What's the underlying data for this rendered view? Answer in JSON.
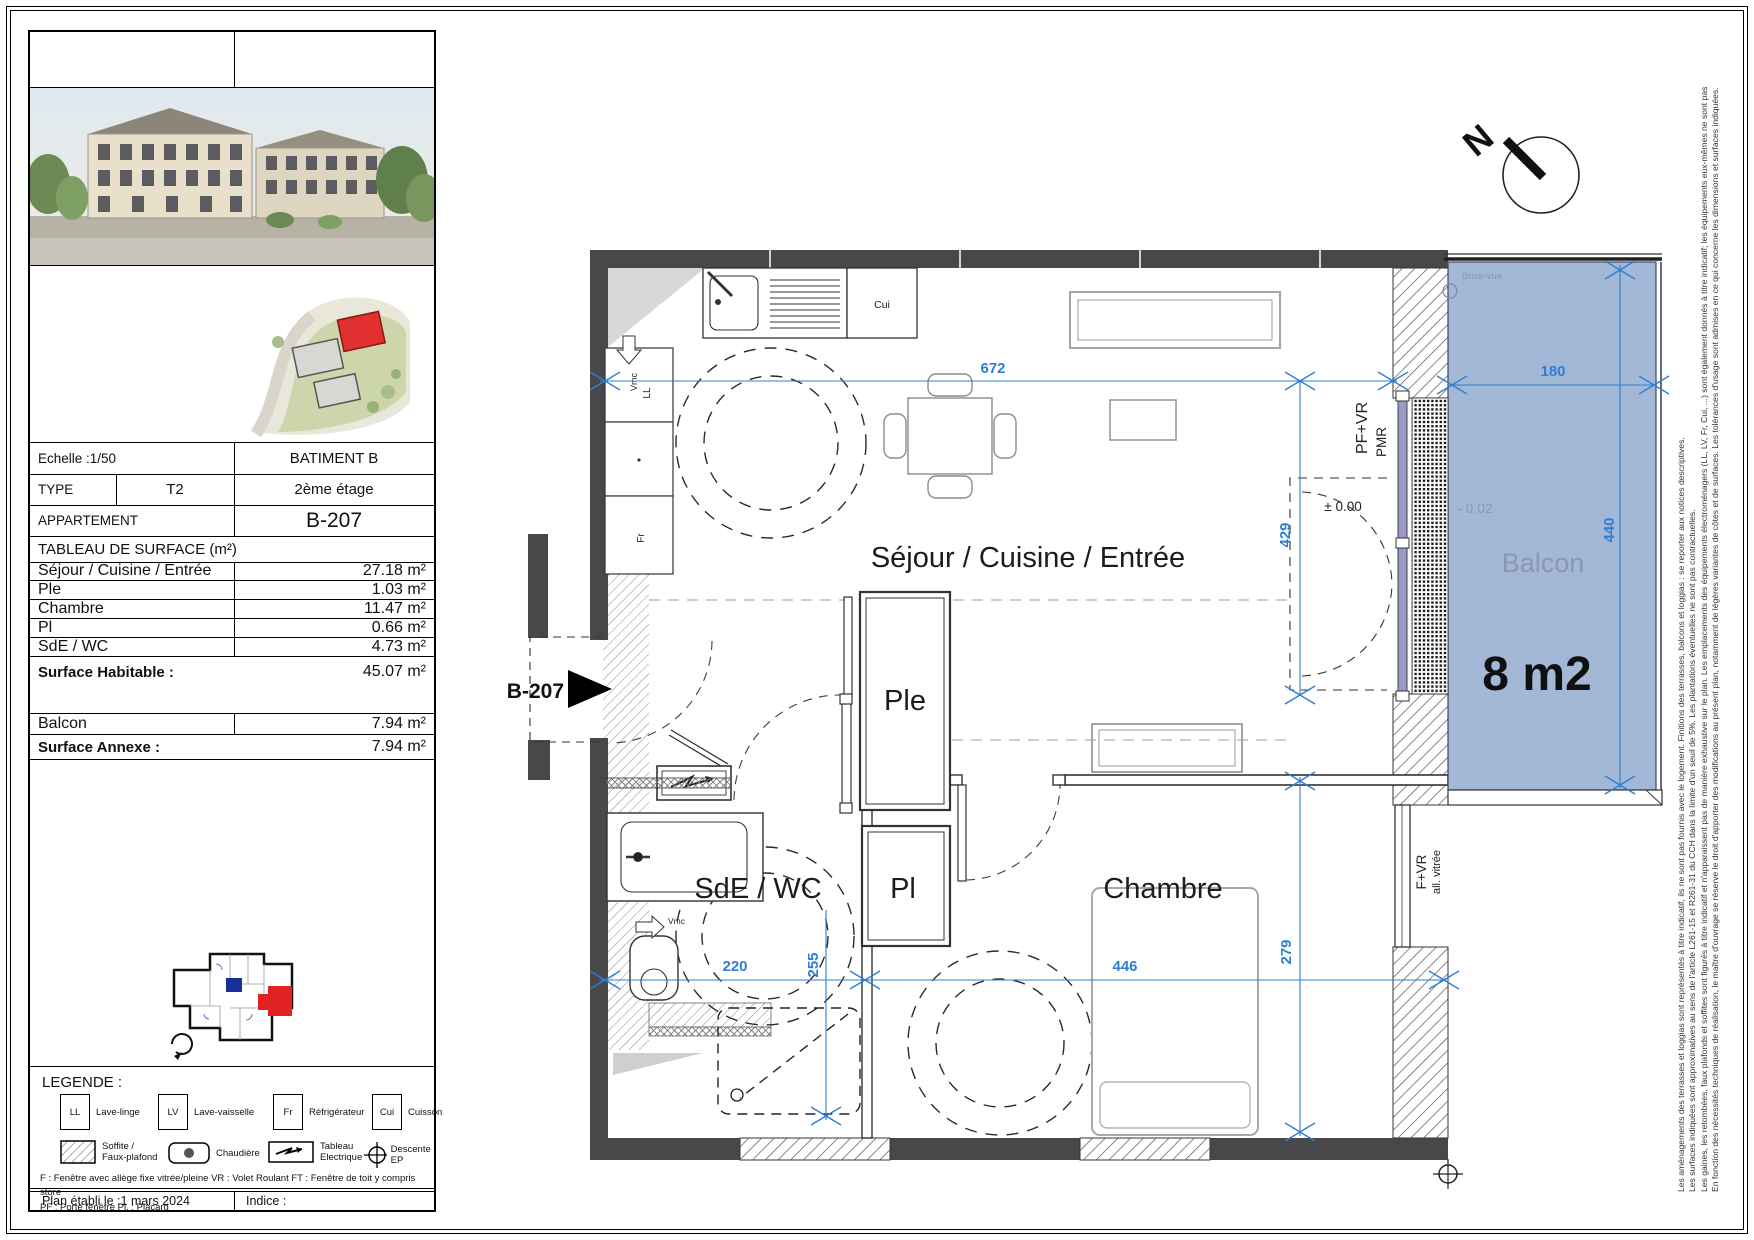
{
  "page": {
    "colors": {
      "dim_blue": "#2e7fd4",
      "balcony_fill": "#a3b8d6",
      "wall": "#48484a",
      "label_gray": "#8a97ad",
      "key_unit_red": "#e02222",
      "key_unit_blue": "#1a2f9e"
    }
  },
  "title_block": {
    "echelle": "Echelle :1/50",
    "batiment": "BATIMENT B",
    "type_label": "TYPE",
    "type_value": "T2",
    "etage": "2ème étage",
    "appartement_label": "APPARTEMENT",
    "appartement_value": "B-207",
    "table_title": "TABLEAU DE SURFACE (m²)",
    "rows": [
      {
        "label": "Séjour / Cuisine / Entrée",
        "value": "27.18 m²"
      },
      {
        "label": "Ple",
        "value": "1.03 m²"
      },
      {
        "label": "Chambre",
        "value": "11.47 m²"
      },
      {
        "label": "Pl",
        "value": "0.66 m²"
      },
      {
        "label": "SdE / WC",
        "value": "4.73 m²"
      }
    ],
    "habitable_label": "Surface Habitable :",
    "habitable_value": "45.07 m²",
    "balcon_label": "Balcon",
    "balcon_value": "7.94 m²",
    "annexe_label": "Surface Annexe :",
    "annexe_value": "7.94 m²"
  },
  "legend": {
    "title": "LEGENDE :",
    "appliances": [
      {
        "abbr": "LL",
        "label": "Lave-linge"
      },
      {
        "abbr": "LV",
        "label": "Lave-vaisselle"
      },
      {
        "abbr": "Fr",
        "label": "Réfrigérateur"
      },
      {
        "abbr": "Cui",
        "label": "Cuisson"
      }
    ],
    "symbols": [
      {
        "label1": "Soffite /",
        "label2": "Faux-plafond"
      },
      {
        "label1": "Chaudière",
        "label2": ""
      },
      {
        "label1": "Tableau",
        "label2": "Electrique"
      },
      {
        "label1": "Descente EP",
        "label2": ""
      }
    ],
    "notes_line1": "F :  Fenêtre avec allège fixe vitrée/pleine    VR : Volet Roulant    FT : Fenêtre de toit y compris store",
    "notes_line2": "PF : Porte fenêtre    Pl. : Placard"
  },
  "footer": {
    "date": "Plan établi le :1 mars 2024",
    "indice": "Indice :"
  },
  "plan": {
    "north": "N",
    "entrance": "B-207",
    "room_sejour": "Séjour / Cuisine / Entrée",
    "room_ple": "Ple",
    "room_pl": "Pl",
    "room_sde": "SdE / WC",
    "room_chambre": "Chambre",
    "room_balcon": "Balcon",
    "balcon_area": "8 m2",
    "level_balcon": "- 0.02",
    "level_interior": "± 0.00",
    "brise_vue": "Brise-vue",
    "win_pfvr": "PF+VR",
    "win_pmr": "PMR",
    "win_fvr": "F+VR",
    "win_allvitree": "all. vitrée",
    "fix_cui": "Cui",
    "fix_ll": "LL",
    "fix_fr": "Fr",
    "fix_vmc_kitchen": "Vmc",
    "fix_vmc_sde": "Vmc",
    "dim_672": "672",
    "dim_429": "429",
    "dim_180": "180",
    "dim_440": "440",
    "dim_220": "220",
    "dim_255": "255",
    "dim_446": "446",
    "dim_279": "279"
  },
  "disclaimer": {
    "lines": [
      "En fonction des nécessités techniques de réalisation, le maître d'ouvrage se réserve le droit d'apporter des modifications au présent plan, notamment de légères variantes de côtes et de surfaces. Les tolérances d'usage sont admises en ce qui concerne les dimensions et surfaces indiquées.",
      "Les gaines, les retombées, faux plafonds et soffites sont figurés à titre indicatif et n'apparaissent pas de manière exhaustive sur le plan. Les emplacements des équipements électroménagers (LL, LV, Fr, Cui, ...) sont également donnés à titre indicatif; les équipements eux-mêmes ne sont pas fournis.",
      "Les surfaces indiquées sont approximatives au sens de l'article L261-15 et R261-31 du CCH dans la limite d'un seuil de 5%. Les plantations éventuelles ne sont pas contractuelles.",
      "Les aménagements des terrasses et loggias sont représentés à titre indicatif, ils ne sont pas fournis avec le logement. Finitions des terrasses, balcons et loggias : se reporter aux notices descriptives."
    ]
  }
}
